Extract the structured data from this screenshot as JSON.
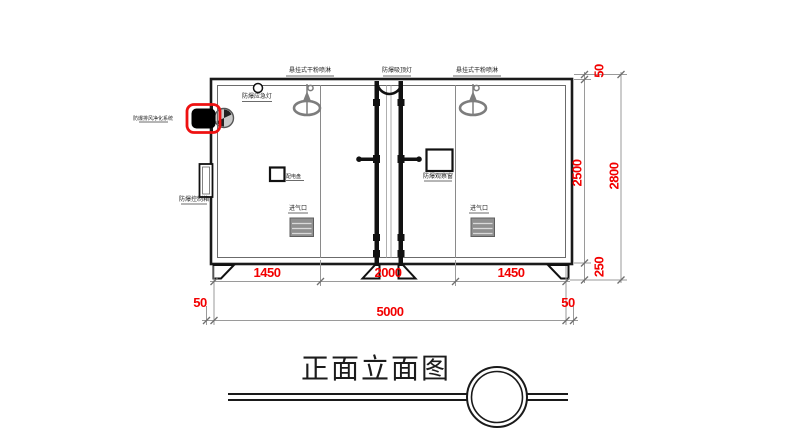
{
  "drawing": {
    "title": "正面立面图",
    "labels": {
      "sprinkler_left": "悬挂式干粉喷淋",
      "ceiling_lamp": "防爆吸顶灯",
      "sprinkler_right": "悬挂式干粉喷淋",
      "emergency_lamp": "防爆应急灯",
      "exhaust_purification": "防爆排风净化系统",
      "control_box": "防爆控制箱",
      "power_panel": "配电盘",
      "observation_window": "防爆观察窗",
      "air_inlet_left": "进气口",
      "air_inlet_right": "进气口"
    },
    "dimensions": {
      "bottom_segments": [
        "1450",
        "2000",
        "1450"
      ],
      "bottom_left_margin": "50",
      "bottom_total": "5000",
      "bottom_right_margin": "50",
      "right_top": "50",
      "right_body": "2500",
      "right_base": "250",
      "right_total": "2800"
    },
    "colors": {
      "dimension_text": "#f20000",
      "fan_highlight": "#ee1111",
      "primary_line": "#1a1a1a",
      "secondary_line": "#8a8a8a"
    }
  }
}
